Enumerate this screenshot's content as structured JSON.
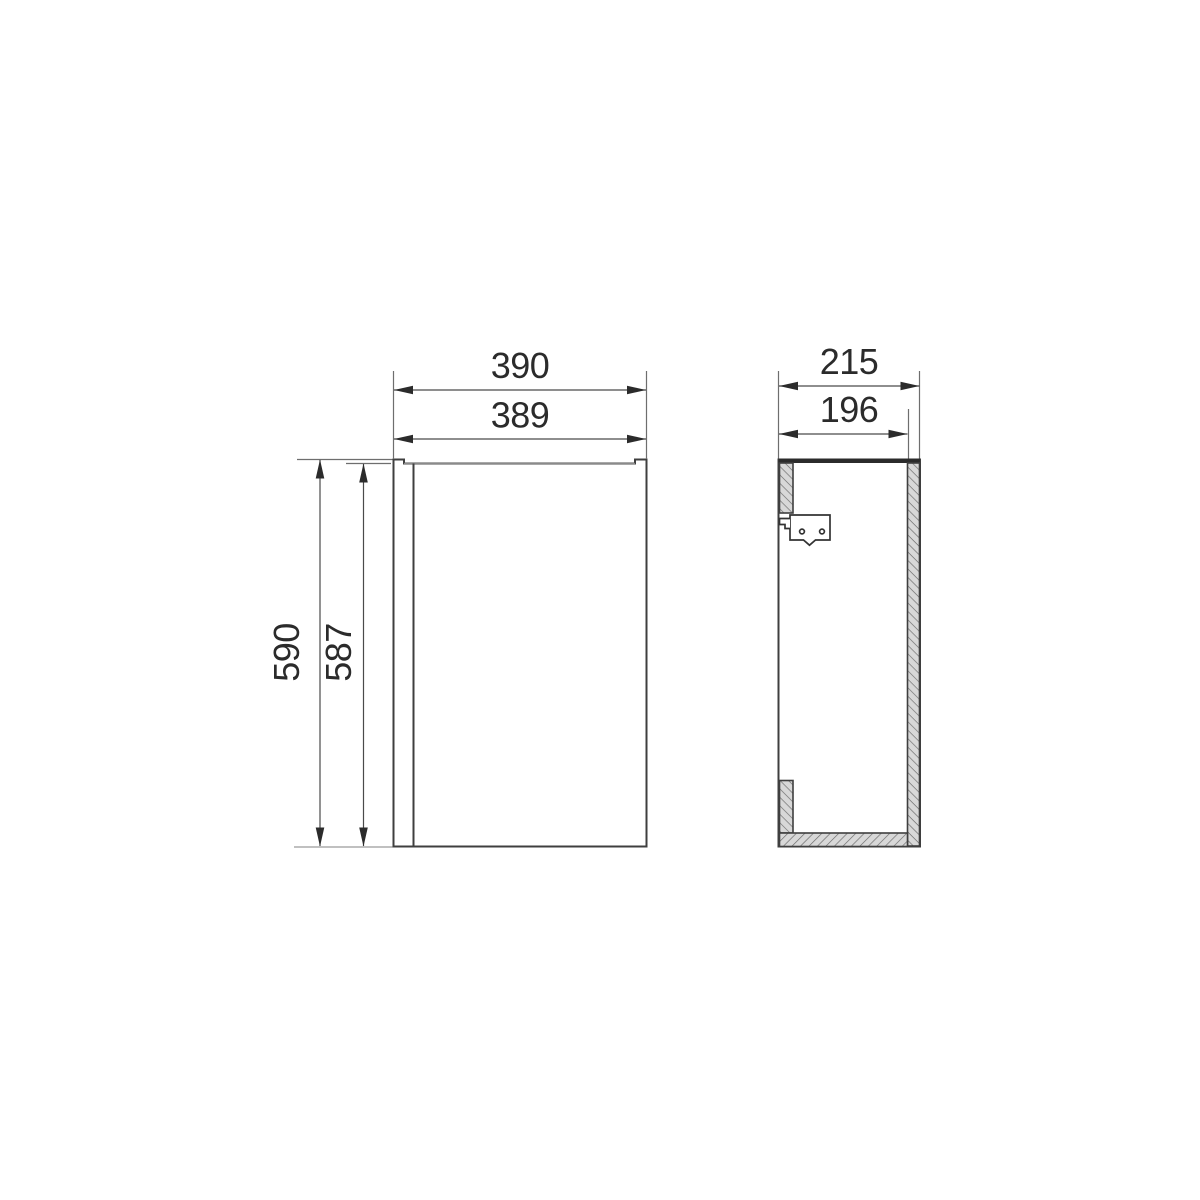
{
  "drawing": {
    "front_view": {
      "width_total": "390",
      "width_door": "389",
      "height_total": "590",
      "height_door": "587"
    },
    "side_view": {
      "depth_total": "215",
      "depth_body": "196"
    },
    "colors": {
      "background": "#ffffff",
      "outline": "#3f3f3f",
      "dimension_line": "#4a4a4a",
      "extension_line": "#6e6e6e",
      "text_and_arrows": "#2b2b2b",
      "hatch_fill": "#d8d8d8",
      "hatch_stroke": "#6a6a6a",
      "top_edge_bar": "#2b2b2b"
    }
  }
}
